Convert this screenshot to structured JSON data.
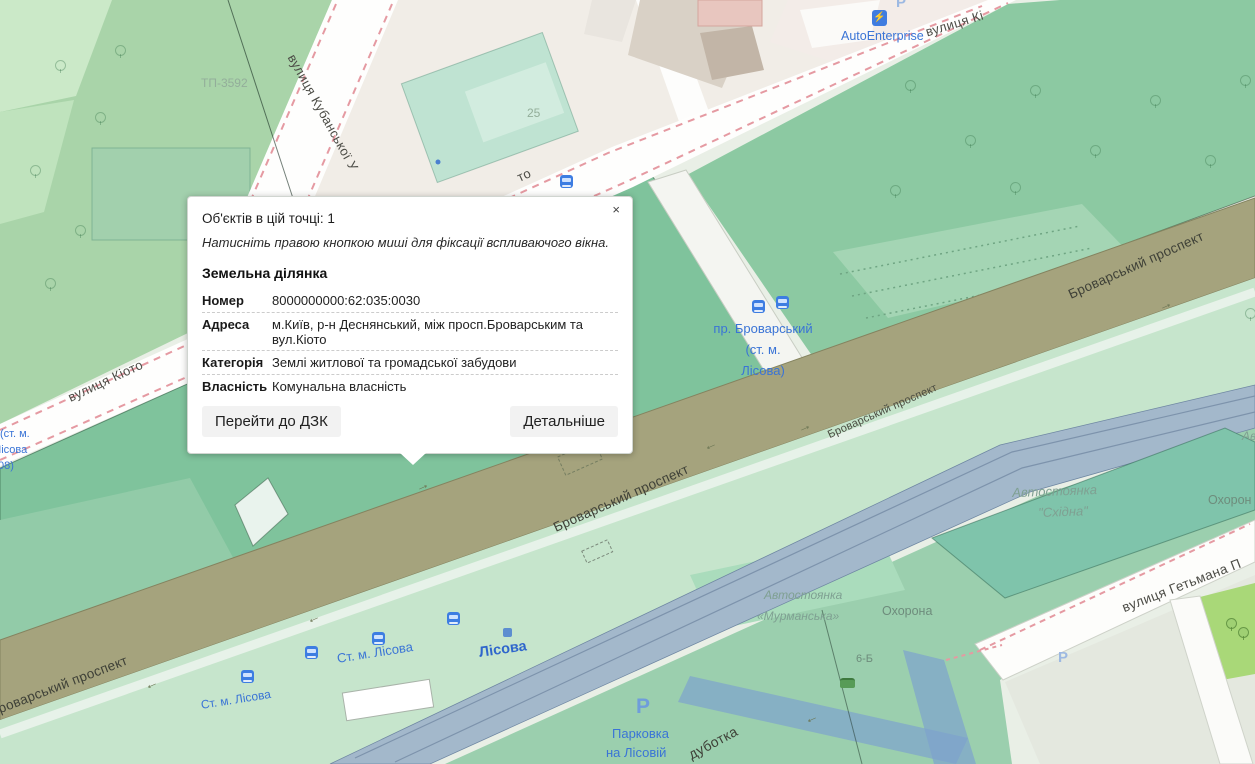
{
  "popup": {
    "close_label": "×",
    "objects_line": "Об'єктів в цій точці: 1",
    "hint_line": "Натисніть правою кнопкою миші для фіксації вспливаючого вікна.",
    "section_title": "Земельна ділянка",
    "fields": [
      {
        "label": "Номер",
        "value": "8000000000:62:035:0030"
      },
      {
        "label": "Адреса",
        "value": "м.Київ, р-н Деснянський, між просп.Броварським та вул.Кіото"
      },
      {
        "label": "Категорія",
        "value": "Землі житлової та громадської забудови"
      },
      {
        "label": "Власність",
        "value": "Комунальна власність"
      }
    ],
    "buttons": {
      "primary": "Перейти до ДЗК",
      "secondary": "Детальніше"
    }
  },
  "map": {
    "colors": {
      "parcel_green": "#7fc39c",
      "road_olive": "#a5a37d",
      "rail_blue": "#a3b8cb",
      "poi_blue": "#3a74d6",
      "red_dash": "#e59aa2",
      "teal_parking": "#7fc4ab"
    },
    "arrow_glyph": "→",
    "labels": [
      {
        "n": "substation-label",
        "t": "ТП-3592",
        "x": 201,
        "y": 77,
        "r": 0,
        "c": "faded"
      },
      {
        "n": "street-label-kubanska",
        "t": "вулиця Кубанської У",
        "x": 297,
        "y": 52,
        "r": 61,
        "c": "street"
      },
      {
        "n": "housenumber-25",
        "t": "25",
        "x": 527,
        "y": 107,
        "r": 0,
        "c": "faded"
      },
      {
        "n": "street-label-kioto-left",
        "t": "вулиця Кіото",
        "x": 66,
        "y": 392,
        "r": -25,
        "c": "street"
      },
      {
        "n": "street-label-kioto-frag",
        "t": "то",
        "x": 515,
        "y": 172,
        "r": -25,
        "c": "street"
      },
      {
        "n": "street-label-kioto-topright",
        "t": "вулиця Кі",
        "x": 924,
        "y": 26,
        "r": -17,
        "c": "street"
      },
      {
        "n": "poi-autoenterprise",
        "t": "AutoEnterprise",
        "x": 841,
        "y": 29,
        "r": 0,
        "c": "poiblue",
        "fs": 12.5
      },
      {
        "n": "road-label-brovarsky-ne",
        "t": "Броварський проспект",
        "x": 1066,
        "y": 288,
        "r": -24,
        "c": "road"
      },
      {
        "n": "poi-pr-brovarsky-1",
        "t": "пр. Броварський",
        "x": 763,
        "y": 322,
        "r": 0,
        "c": "poiblue",
        "center": true
      },
      {
        "n": "poi-pr-brovarsky-2",
        "t": "(ст. м.",
        "x": 763,
        "y": 343,
        "r": 0,
        "c": "poiblue",
        "center": true
      },
      {
        "n": "poi-pr-brovarsky-3",
        "t": "Лісова)",
        "x": 763,
        "y": 364,
        "r": 0,
        "c": "poiblue",
        "center": true
      },
      {
        "n": "road-label-brovarsky-mid",
        "t": "Броварський проспект",
        "x": 551,
        "y": 521,
        "r": -24,
        "c": "road"
      },
      {
        "n": "road-label-brovarsky-mid2",
        "t": "Броварський проспект",
        "x": 826,
        "y": 430,
        "r": -24,
        "c": "road-sm"
      },
      {
        "n": "road-label-brovarsky-sw",
        "t": "роварський проспект",
        "x": -4,
        "y": 702,
        "r": -21,
        "c": "road"
      },
      {
        "n": "poi-st-m-lisova-1",
        "t": "Ст. м. Лісова",
        "x": 336,
        "y": 652,
        "r": -9,
        "c": "poiblue"
      },
      {
        "n": "poi-st-m-lisova-2",
        "t": "Ст. м. Лісова",
        "x": 200,
        "y": 699,
        "r": -9,
        "c": "poiblue",
        "fs": 12
      },
      {
        "n": "poi-lisova",
        "t": "Лісова",
        "x": 478,
        "y": 645,
        "r": -8,
        "c": "poibold"
      },
      {
        "n": "area-label-skhidna-1",
        "t": "Автостоянка",
        "x": 1012,
        "y": 486,
        "r": -2,
        "c": "area",
        "fs": 13
      },
      {
        "n": "area-label-skhidna-2",
        "t": "\"Східна\"",
        "x": 1038,
        "y": 506,
        "r": -2,
        "c": "area",
        "fs": 13
      },
      {
        "n": "area-label-murmanska-1",
        "t": "Автостоянка",
        "x": 764,
        "y": 589,
        "r": 0,
        "c": "area"
      },
      {
        "n": "area-label-murmanska-2",
        "t": "«Мурманська»",
        "x": 757,
        "y": 610,
        "r": 0,
        "c": "area"
      },
      {
        "n": "place-label-okhorona",
        "t": "Охорона",
        "x": 882,
        "y": 604,
        "r": 0,
        "c": "place"
      },
      {
        "n": "place-label-okhorona-frag",
        "t": "Охорон",
        "x": 1208,
        "y": 493,
        "r": 0,
        "c": "place"
      },
      {
        "n": "area-label-frag",
        "t": "Ав",
        "x": 1242,
        "y": 430,
        "r": 0,
        "c": "area"
      },
      {
        "n": "street-label-hetmana",
        "t": "вулиця Гетьмана П",
        "x": 1120,
        "y": 601,
        "r": -21,
        "c": "street",
        "fs": 13.5
      },
      {
        "n": "ghost-label-pryzupynene",
        "t": "призупинене)",
        "x": 377,
        "y": 410,
        "r": -1,
        "c": "ghost"
      },
      {
        "n": "parking-p-big",
        "t": "P",
        "x": 636,
        "y": 695,
        "r": 0,
        "c": "pbig"
      },
      {
        "n": "poi-parkovka-1",
        "t": "Парковка",
        "x": 612,
        "y": 727,
        "r": 0,
        "c": "poiblue",
        "fs": 13
      },
      {
        "n": "poi-parkovka-2",
        "t": "на Лісовій",
        "x": 606,
        "y": 746,
        "r": 0,
        "c": "poiblue",
        "fs": 13
      },
      {
        "n": "road-label-dubotka",
        "t": "дуботка",
        "x": 686,
        "y": 749,
        "r": -28,
        "c": "road",
        "fs": 14
      },
      {
        "n": "housenumber-6b",
        "t": "6-Б",
        "x": 856,
        "y": 653,
        "r": 0,
        "c": "place",
        "fs": 11
      },
      {
        "n": "poi-stm-frag-1",
        "t": "(ст. м.",
        "x": 0,
        "y": 428,
        "r": 0,
        "c": "poiblue",
        "fs": 11
      },
      {
        "n": "poi-stm-frag-2",
        "t": "Лісова",
        "x": -6,
        "y": 444,
        "r": 0,
        "c": "poiblue",
        "fs": 11
      },
      {
        "n": "poi-stm-frag-3",
        "t": "08)",
        "x": -2,
        "y": 460,
        "r": 0,
        "c": "poiblue",
        "fs": 11
      },
      {
        "n": "parking-p-top",
        "t": "P",
        "x": 896,
        "y": -5,
        "r": 0,
        "c": "pfade"
      },
      {
        "n": "parking-p-faded",
        "t": "P",
        "x": 1058,
        "y": 650,
        "r": 0,
        "c": "pfade"
      }
    ],
    "icons": [
      {
        "k": "bus-stop",
        "x": 560,
        "y": 175
      },
      {
        "k": "bus-stop",
        "x": 752,
        "y": 300
      },
      {
        "k": "bus-stop",
        "x": 776,
        "y": 296
      },
      {
        "k": "bus-stop",
        "x": 305,
        "y": 646
      },
      {
        "k": "bus-stop",
        "x": 372,
        "y": 632
      },
      {
        "k": "bus-stop",
        "x": 241,
        "y": 670
      },
      {
        "k": "bus-stop",
        "x": 447,
        "y": 612
      },
      {
        "k": "metro-entrance",
        "x": 503,
        "y": 628
      },
      {
        "k": "ev-charging",
        "x": 872,
        "y": 10,
        "g": "⚡"
      },
      {
        "k": "car",
        "x": 840,
        "y": 678
      }
    ],
    "arrows": [
      {
        "x": 415,
        "y": 477,
        "r": -24
      },
      {
        "x": 705,
        "y": 441,
        "r": 156
      },
      {
        "x": 797,
        "y": 418,
        "r": -24
      },
      {
        "x": 146,
        "y": 680,
        "r": 156
      },
      {
        "x": 1158,
        "y": 296,
        "r": -24
      },
      {
        "x": 806,
        "y": 714,
        "r": 156
      },
      {
        "x": 308,
        "y": 614,
        "r": 156
      }
    ],
    "trees": [
      [
        55,
        60
      ],
      [
        95,
        112
      ],
      [
        30,
        165
      ],
      [
        75,
        225
      ],
      [
        45,
        278
      ],
      [
        115,
        45
      ],
      [
        905,
        80
      ],
      [
        965,
        135
      ],
      [
        1030,
        85
      ],
      [
        1090,
        145
      ],
      [
        1150,
        95
      ],
      [
        1205,
        155
      ],
      [
        1240,
        75
      ],
      [
        890,
        185
      ],
      [
        1010,
        182
      ],
      [
        1245,
        308
      ]
    ],
    "trees_dark": [
      [
        1226,
        618
      ],
      [
        1238,
        627
      ]
    ]
  }
}
